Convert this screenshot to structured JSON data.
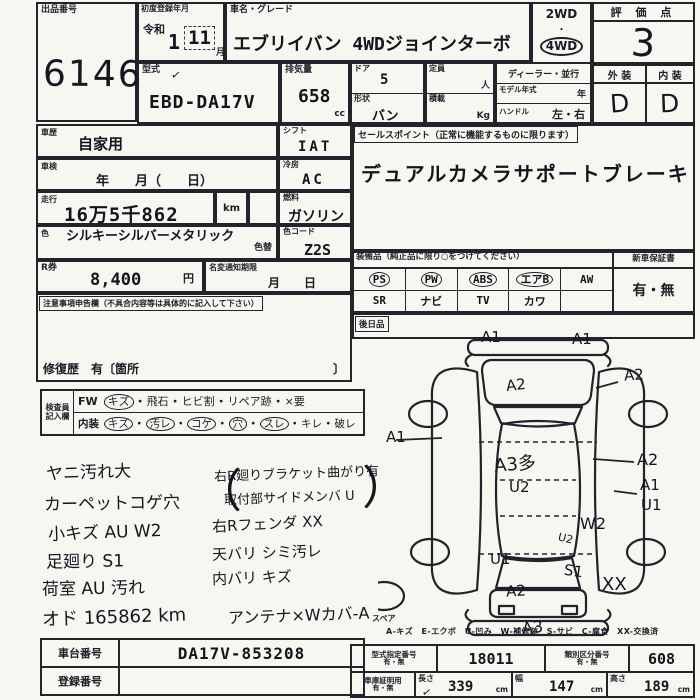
{
  "auction": {
    "label": "出品番号",
    "number": "6146"
  },
  "reg": {
    "label": "初度登録年月",
    "era": "令和",
    "year": "1",
    "month": "11",
    "month_unit": "月"
  },
  "name": {
    "label": "車名・グレード",
    "value": "エブリイバン 4WDジョインターボ"
  },
  "drive": {
    "opt1": "2WD",
    "dot": "・",
    "opt2": "4WD"
  },
  "score": {
    "label": "評 価 点",
    "value": "3"
  },
  "grades": {
    "ext_label": "外 装",
    "int_label": "内 装",
    "ext": "D",
    "int": "D"
  },
  "model": {
    "label": "型式",
    "check": "✓",
    "value": "EBD-DA17V"
  },
  "disp": {
    "label": "排気量",
    "value": "658",
    "unit": "cc"
  },
  "door": {
    "label": "ドア",
    "value": "5"
  },
  "shape": {
    "label": "形状",
    "value": "バン"
  },
  "capacity": {
    "label": "定員",
    "unit": "人"
  },
  "load": {
    "label": "積載",
    "unit": "Kg"
  },
  "dealer": {
    "label": "ディーラー・並行"
  },
  "myear": {
    "label": "モデル年式",
    "unit": "年"
  },
  "handle": {
    "label": "ハンドル",
    "value": "左・右"
  },
  "history": {
    "label": "車歴",
    "value": "自家用"
  },
  "shift": {
    "label": "シフト",
    "value": "IAT"
  },
  "shaken": {
    "label": "車検",
    "value": "年　　月（　　日）"
  },
  "cool": {
    "label": "冷房",
    "value": "AC"
  },
  "run": {
    "label": "走行",
    "value": "16万5千862",
    "unit": "km"
  },
  "fuel": {
    "label": "燃料",
    "value": "ガソリン"
  },
  "color": {
    "label": "色",
    "value": "シルキーシルバーメタリック",
    "change": "色替",
    "code_label": "色コード",
    "code": "Z2S"
  },
  "recycle": {
    "label": "R券",
    "value": "8,400",
    "unit": "円"
  },
  "namechange": {
    "label": "名変通知期限",
    "value": "月　　日"
  },
  "caution": {
    "label": "注意事項申告欄（不具合内容等は具体的に記入して下さい）",
    "repair": "修復歴　有〔箇所",
    "close": "〕"
  },
  "sales": {
    "label": "セールスポイント（正常に機能するものに限ります）",
    "value": "デュアルカメラサポートブレーキ"
  },
  "equip": {
    "label": "装備品（純正品に限り○をつけてください）",
    "row1": [
      {
        "t": "PS",
        "c": true
      },
      {
        "t": "PW",
        "c": true
      },
      {
        "t": "ABS",
        "c": true
      },
      {
        "t": "エアB",
        "c": true
      },
      {
        "t": "AW",
        "c": false
      }
    ],
    "row2": [
      {
        "t": "SR",
        "c": false
      },
      {
        "t": "ナビ",
        "c": false
      },
      {
        "t": "TV",
        "c": false
      },
      {
        "t": "カワ",
        "c": false
      },
      {
        "t": "",
        "c": false
      }
    ],
    "warranty_label": "新車保証書",
    "warranty": "有・無",
    "later_label": "後日品"
  },
  "inspector": {
    "label1": "検査員",
    "label2": "記入欄",
    "head1": "FW",
    "head2": "内装",
    "row1": [
      {
        "t": "キズ",
        "c": true
      },
      {
        "t": "飛石",
        "c": false
      },
      {
        "t": "ヒビ割",
        "c": false
      },
      {
        "t": "リペア跡",
        "c": false
      },
      {
        "t": "×要",
        "c": false
      }
    ],
    "row2": [
      {
        "t": "キズ",
        "c": true
      },
      {
        "t": "汚レ",
        "c": true
      },
      {
        "t": "コゲ",
        "c": true
      },
      {
        "t": "穴",
        "c": true
      },
      {
        "t": "スレ",
        "c": true
      },
      {
        "t": "キレ",
        "c": false
      },
      {
        "t": "破レ",
        "c": false
      }
    ]
  },
  "notes": {
    "left": [
      "ヤニ汚れ大",
      "カーペットコゲ穴",
      "小キズ AU W2",
      "足廻り S1",
      "荷室 AU 汚れ",
      "オド 165862 km"
    ],
    "right": [
      "右R廻りブラケット曲がり有",
      "取付部サイドメンバ U",
      "右Rフェンダ XX",
      "天バリ シミ汚レ",
      "内バリ キズ",
      "アンテナ×Wカバ-A"
    ],
    "paren_open": "（",
    "paren_close": "）"
  },
  "diagram": {
    "marks": [
      {
        "t": "A1"
      },
      {
        "t": "A1"
      },
      {
        "t": "A2"
      },
      {
        "t": "A2"
      },
      {
        "t": "A1"
      },
      {
        "t": "A3多"
      },
      {
        "t": "U2"
      },
      {
        "t": "A2"
      },
      {
        "t": "A1"
      },
      {
        "t": "U1"
      },
      {
        "t": "W2"
      },
      {
        "t": "U2"
      },
      {
        "t": "U1"
      },
      {
        "t": "S1"
      },
      {
        "t": "A2"
      },
      {
        "t": "XX"
      },
      {
        "t": "A3"
      }
    ],
    "spare": "スペア",
    "legend": "A-キズ　E-エクボ　U-凹み　W-補修跡　S-サビ　C-腐食　XX-交換済"
  },
  "bottom": {
    "vin_label": "車台番号",
    "vin": "DA17V-853208",
    "plate_label": "登録番号",
    "plate": "",
    "type_label": "型式指定番号",
    "type_sub": "有・無",
    "type_value": "18011",
    "class_label": "類別区分番号",
    "class_sub": "有・無",
    "class_value": "608",
    "garage_label": "車庫証明用",
    "garage_sub": "有・無",
    "check": "✓",
    "len_label": "長さ",
    "len": "339",
    "wid_label": "幅",
    "wid": "147",
    "hei_label": "高さ",
    "hei": "189",
    "cm": "cm"
  }
}
